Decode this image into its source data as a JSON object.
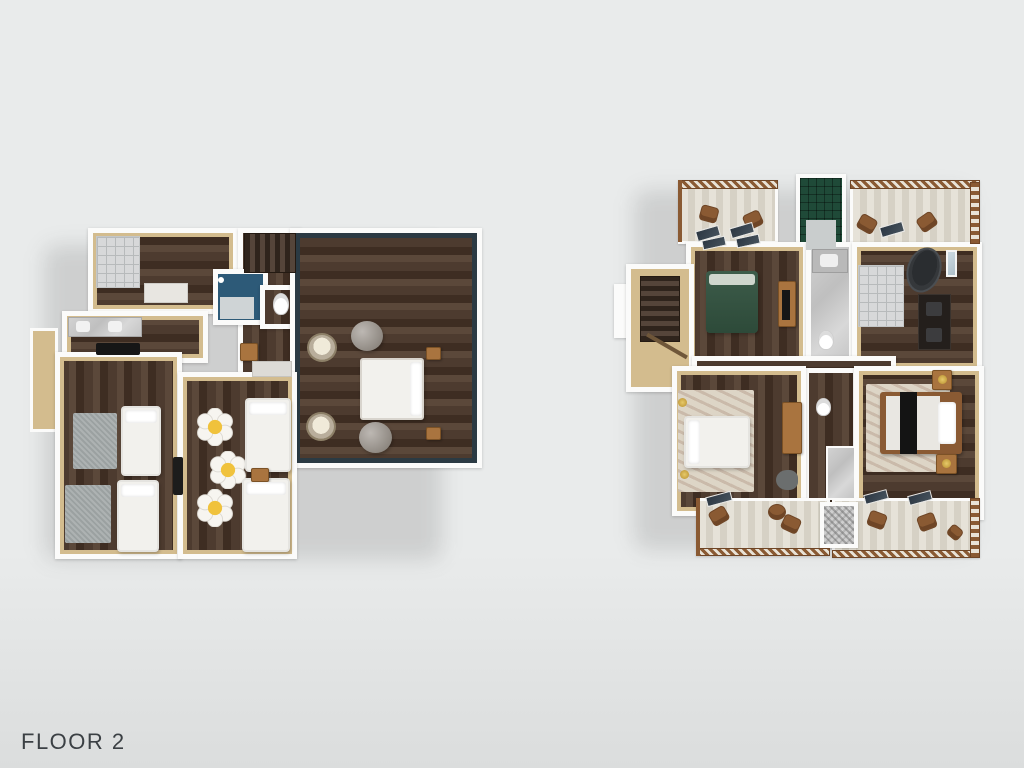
{
  "page": {
    "label": "FLOOR 2"
  },
  "palette": {
    "background": "#e9ebeb",
    "background_bottom": "#dbdddd",
    "wall_white": "#fbfbfa",
    "wall_tan": "#d3bc8e",
    "wall_tan_dark": "#b99f72",
    "floor_dark": "#4d3b2f",
    "floor_dark2": "#5b483a",
    "floor_dark3": "#3e2d22",
    "accent_navy": "#2b3a43",
    "bed_white": "#f2f1ed",
    "bed_green": "#3d5c4a",
    "bed_green_dark": "#2d4a39",
    "rug_gray": "#9ba1a1",
    "rug_cream": "#ddd5c6",
    "daisy_white": "#f7f5f0",
    "daisy_yellow": "#f0c23c",
    "deck_plank": "#e6e2d8",
    "deck_plank2": "#d6d1c5",
    "railing_brown": "#8a5a33",
    "wood_furniture": "#a9743f",
    "tub_dark": "#35383b",
    "tile_light": "#d7d8d9",
    "tile_line": "#b7babb",
    "tile_green": "#1f4a38",
    "marble": "#c9c9c9",
    "bathroom_blue": "#2d5a78",
    "tv_black": "#161616",
    "label_color": "#3b4044"
  }
}
